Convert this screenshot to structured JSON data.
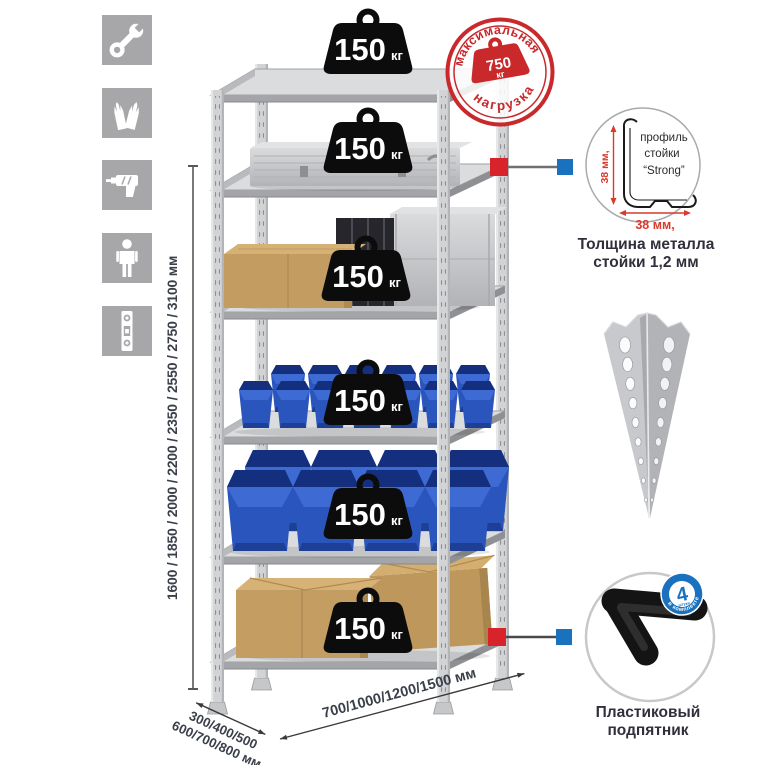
{
  "assembly_icons": [
    {
      "name": "wrench"
    },
    {
      "name": "gloves"
    },
    {
      "name": "drill"
    },
    {
      "name": "person"
    },
    {
      "name": "level"
    }
  ],
  "height_dimension_label": "1600 / 1850 / 2000 / 2200 / 2350 / 2550 / 2750 / 3100 мм",
  "rack": {
    "shelves": [
      {
        "load": "150",
        "unit": "кг"
      },
      {
        "load": "150",
        "unit": "кг"
      },
      {
        "load": "150",
        "unit": "кг"
      },
      {
        "load": "150",
        "unit": "кг"
      },
      {
        "load": "150",
        "unit": "кг"
      },
      {
        "load": "150",
        "unit": "кг"
      }
    ]
  },
  "max_load_stamp": {
    "arc_top": "максимальная",
    "arc_bottom": "нагрузка",
    "value": "750",
    "unit": "кг"
  },
  "profile_detail": {
    "label_line1": "профиль",
    "label_line2": "стойки",
    "label_line3": "“Strong”",
    "dim_vertical": "38 мм,",
    "dim_horizontal": "38 мм,",
    "caption_line1": "Толщина металла",
    "caption_line2": "стойки 1,2 мм"
  },
  "foot_detail": {
    "badge_value": "4",
    "badge_sub": "штуки",
    "badge_arc": "в комплекте",
    "caption_line1": "Пластиковый",
    "caption_line2": "подпятник"
  },
  "depth_dimension": {
    "line1": "300/400/500",
    "line2": "600/700/800 мм"
  },
  "width_dimension_label": "700/1000/1200/1500 мм",
  "colors": {
    "stamp_red": "#c9292b",
    "dim_red": "#d93a2b",
    "callout_red": "#d8232b",
    "callout_blue": "#1a72bf",
    "badge_blue": "#1a72bf",
    "bin_blue": "#2a55bd",
    "icon_gray": "#a7a7a9",
    "metal_gray": "#d2d3d5",
    "text_dark": "#34343f"
  }
}
